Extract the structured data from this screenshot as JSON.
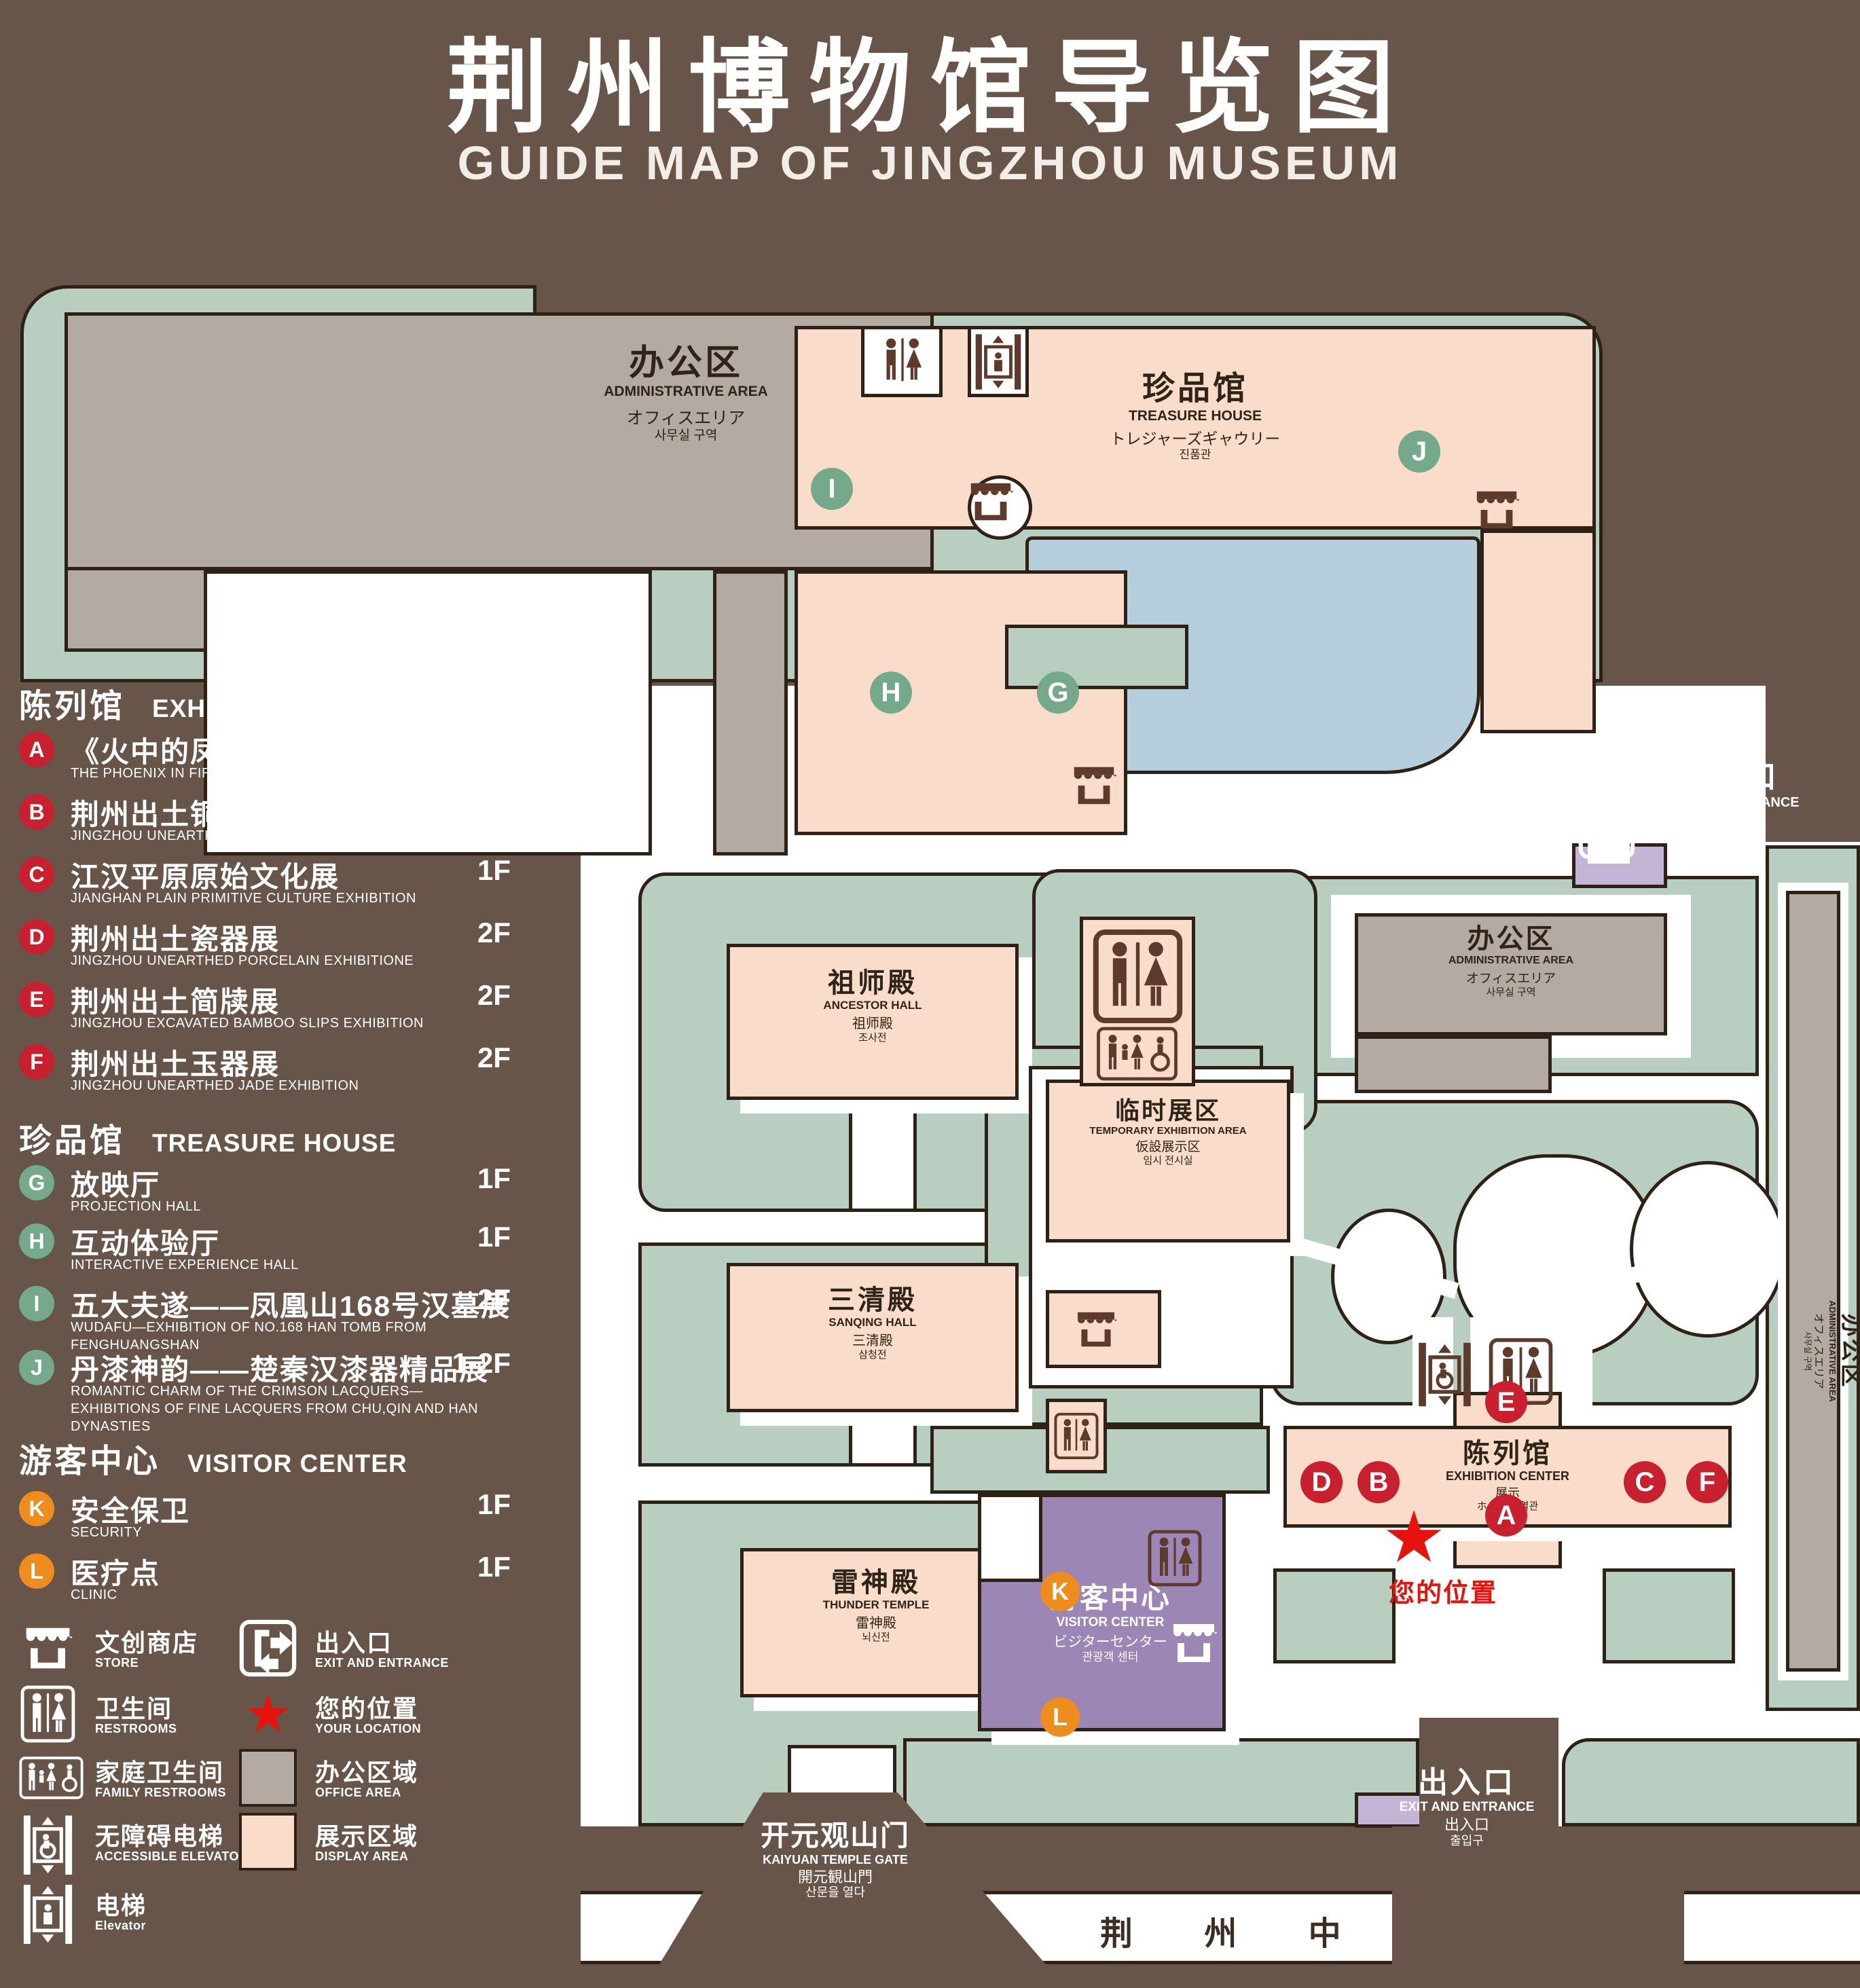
{
  "title": {
    "zh": "荆州博物馆导览图",
    "en": "GUIDE MAP OF JINGZHOU MUSEUM"
  },
  "colors": {
    "background": "#665548",
    "green_area": "#b7cec0",
    "display_area": "#f9dcc9",
    "office_area": "#b3aaa3",
    "pond": "#b4cedd",
    "visitor_center": "#9c86b6",
    "badge_red": "#c8202e",
    "badge_green": "#74a98c",
    "badge_orange": "#ee8c1e",
    "location_red": "#e8120c"
  },
  "legend": {
    "sections": [
      {
        "zh": "陈列馆",
        "en": "EXHIBITION CENTER",
        "items": [
          {
            "id": "A",
            "zh": "《火中的凤凰》壁画",
            "en": "THE PHOENIX IN FIRE \"MURAL PAINTING",
            "floor": "1F"
          },
          {
            "id": "B",
            "zh": "荆州出土铜器展",
            "en": "JINGZHOU UNEARTHED BRONZE WARE EXHIBITION",
            "floor": "1F"
          },
          {
            "id": "C",
            "zh": "江汉平原原始文化展",
            "en": "JIANGHAN PLAIN PRIMITIVE CULTURE EXHIBITION",
            "floor": "1F"
          },
          {
            "id": "D",
            "zh": "荆州出土瓷器展",
            "en": "JINGZHOU UNEARTHED PORCELAIN EXHIBITIONE",
            "floor": "2F"
          },
          {
            "id": "E",
            "zh": "荆州出土简牍展",
            "en": "JINGZHOU EXCAVATED BAMBOO SLIPS EXHIBITION",
            "floor": "2F"
          },
          {
            "id": "F",
            "zh": "荆州出土玉器展",
            "en": "JINGZHOU UNEARTHED JADE EXHIBITION",
            "floor": "2F"
          }
        ]
      },
      {
        "zh": "珍品馆",
        "en": "TREASURE HOUSE",
        "items": [
          {
            "id": "G",
            "zh": "放映厅",
            "en": "PROJECTION HALL",
            "floor": "1F"
          },
          {
            "id": "H",
            "zh": "互动体验厅",
            "en": "INTERACTIVE EXPERIENCE HALL",
            "floor": "1F"
          },
          {
            "id": "I",
            "zh": "五大夫遂——凤凰山168号汉墓展",
            "en": "WUDAFU—EXHIBITION OF NO.168 HAN TOMB FROM FENGHUANGSHAN",
            "floor": "2F"
          },
          {
            "id": "J",
            "zh": "丹漆神韵——楚秦汉漆器精品展",
            "en": "ROMANTIC CHARM OF THE CRIMSON LACQUERS—EXHIBITIONS OF FINE LACQUERS FROM CHU,QIN AND HAN DYNASTIES",
            "floor": "1-2F"
          }
        ]
      },
      {
        "zh": "游客中心",
        "en": "VISITOR CENTER",
        "items": [
          {
            "id": "K",
            "zh": "安全保卫",
            "en": "SECURITY",
            "floor": "1F"
          },
          {
            "id": "L",
            "zh": "医疗点",
            "en": "CLINIC",
            "floor": "1F"
          }
        ]
      }
    ],
    "symbols": [
      {
        "zh": "文创商店",
        "en": "STORE"
      },
      {
        "zh": "卫生间",
        "en": "RESTROOMS"
      },
      {
        "zh": "家庭卫生间",
        "en": "FAMILY RESTROOMS"
      },
      {
        "zh": "无障碍电梯",
        "en": "ACCESSIBLE ELEVATOR"
      },
      {
        "zh": "电梯",
        "en": "Elevator"
      },
      {
        "zh": "出入口",
        "en": "EXIT AND ENTRANCE"
      },
      {
        "zh": "您的位置",
        "en": "YOUR LOCATION"
      },
      {
        "zh": "办公区域",
        "en": "OFFICE AREA"
      },
      {
        "zh": "展示区域",
        "en": "DISPLAY AREA"
      }
    ]
  },
  "map": {
    "buildings": {
      "admin_northwest": {
        "zh": "办公区",
        "en": "ADMINISTRATIVE AREA",
        "ja": "オフィスエリア",
        "ko": "사무실 구역"
      },
      "admin_east": {
        "zh": "办公区",
        "en": "ADMINISTRATIVE AREA",
        "ja": "オフィスエリア",
        "ko": "사무실 구역"
      },
      "admin_east_strip": {
        "zh": "办公区",
        "en": "ADMINISTRATIVE AREA",
        "ja": "オフィスエリア",
        "ko": "사무실 구역"
      },
      "treasure_house": {
        "zh": "珍品馆",
        "en": "TREASURE HOUSE",
        "ja": "トレジャーズギャウリー",
        "ko": "진품관"
      },
      "ancestor_hall": {
        "zh": "祖师殿",
        "en": "ANCESTOR HALL",
        "ja": "祖师殿",
        "ko": "조사전"
      },
      "sanqing_hall": {
        "zh": "三清殿",
        "en": "SANQING HALL",
        "ja": "三清殿",
        "ko": "삼청전"
      },
      "thunder_temple": {
        "zh": "雷神殿",
        "en": "THUNDER TEMPLE",
        "ja": "雷神殿",
        "ko": "뇌신전"
      },
      "temporary_exhibition": {
        "zh": "临时展区",
        "en": "TEMPORARY EXHIBITION AREA",
        "ja": "仮設展示区",
        "ko": "임시 전시실"
      },
      "exhibition_center": {
        "zh": "陈列馆",
        "en": "EXHIBITION CENTER",
        "ja": "展示",
        "ko": "ホール 진열관"
      },
      "visitor_center": {
        "zh": "游客中心",
        "en": "VISITOR CENTER",
        "ja": "ビジターセンター",
        "ko": "관광객 센터"
      },
      "kaiyuan_gate": {
        "zh": "开元观山门",
        "en": "KAIYUAN TEMPLE GATE",
        "ja": "開元観山門",
        "ko": "산문을 열다"
      }
    },
    "exits": {
      "northeast": {
        "zh": "出入口",
        "en": "EXIT AND ENTRANCE",
        "ja": "出入口",
        "ko": "출입구"
      },
      "south": {
        "zh": "出入口",
        "en": "EXIT AND ENTRANCE",
        "ja": "出入口",
        "ko": "출입구"
      }
    },
    "road": {
      "name": "荆 州 中 路"
    },
    "your_location_label": "您的位置",
    "location_star": "★",
    "markers": {
      "A": "A",
      "B": "B",
      "C": "C",
      "D": "D",
      "E": "E",
      "F": "F",
      "G": "G",
      "H": "H",
      "I": "I",
      "J": "J",
      "K": "K",
      "L": "L"
    }
  }
}
